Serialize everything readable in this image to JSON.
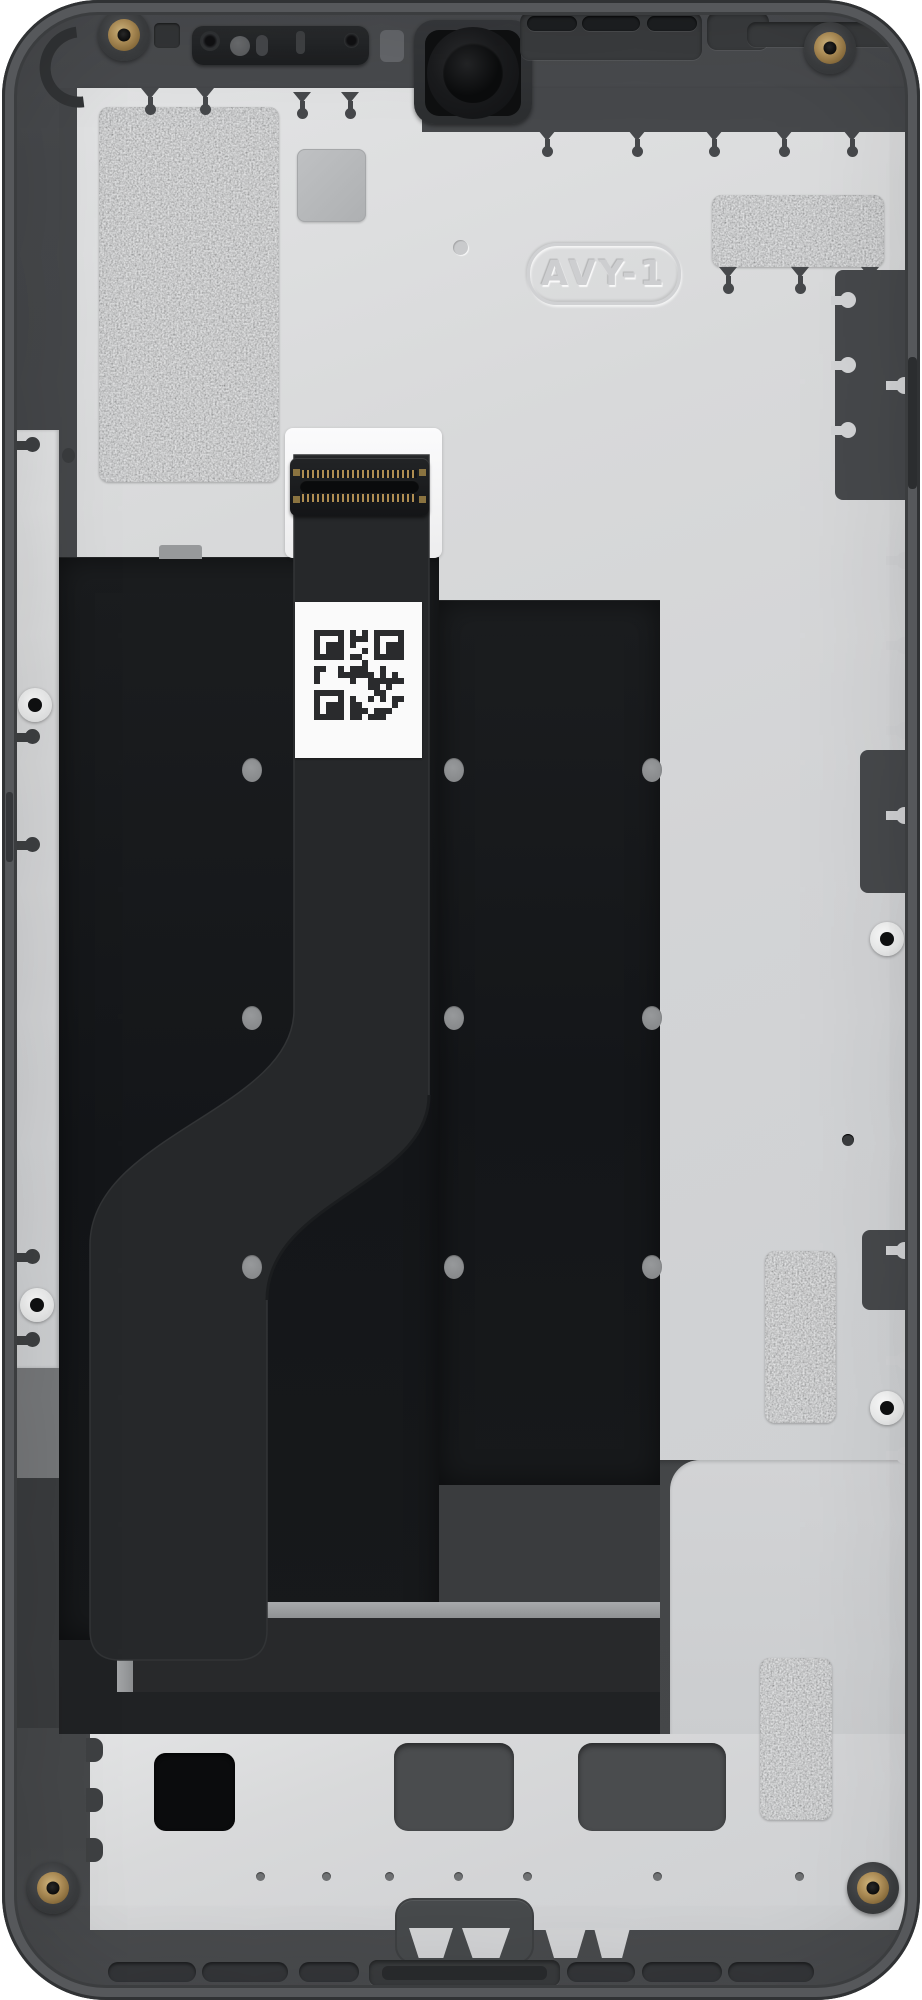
{
  "image": {
    "subject": "smartphone-midframe-display-assembly-rear-view",
    "background_color": "#ffffff"
  },
  "engraving": {
    "text": "AVY-1"
  },
  "stickers": {
    "qr_label": "qr-code-serial-sticker",
    "foil_patches": [
      "top-left-emi-foil",
      "top-right-emi-foil",
      "right-upper-emi-foil",
      "right-lower-emi-foil"
    ]
  },
  "components": {
    "camera": "front-camera-lens",
    "earpiece": "earpiece-sensor-assembly",
    "speaker_grille": "top-speaker-grille-slots",
    "connector": "display-flex-board-connector",
    "ribbon": "display-flex-ribbon-cable",
    "screws": "gold-corner-screws",
    "bosses": "white-screw-bosses"
  },
  "colors": {
    "chassis": "#46484b",
    "plate": "#d6d7d8",
    "panel": "#17191b",
    "ribbon": "#26282a",
    "foil": "#b9babc",
    "screw_gold": "#b3925a",
    "label_white": "#fafafa",
    "qr_ink": "#2a2b2d"
  }
}
